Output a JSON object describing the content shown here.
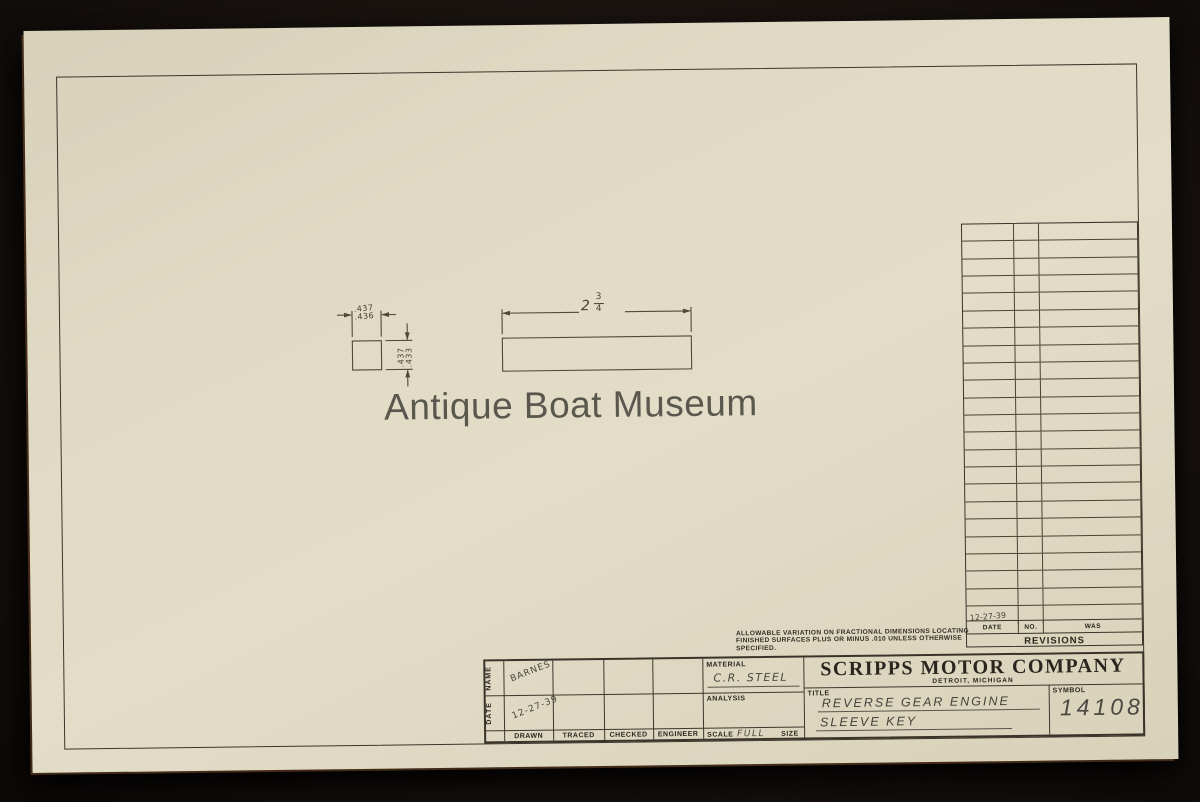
{
  "watermark": "Antique Boat Museum",
  "company": {
    "name": "SCRIPPS MOTOR COMPANY",
    "location": "DETROIT, MICHIGAN"
  },
  "tolerance_note": {
    "line1": "ALLOWABLE VARIATION ON FRACTIONAL DIMENSIONS LOCATING",
    "line2": "FINISHED SURFACES PLUS OR MINUS .010 UNLESS OTHERWISE",
    "line3": "SPECIFIED."
  },
  "dimensions": {
    "width_upper": ".437",
    "width_lower": ".436",
    "height_upper": ".437",
    "height_lower": ".433",
    "length_whole": "2",
    "length_numerator": "3",
    "length_denominator": "4"
  },
  "title_block": {
    "name_label": "NAME",
    "date_label": "DATE",
    "role_labels": [
      "DRAWN",
      "TRACED",
      "CHECKED",
      "ENGINEER"
    ],
    "drawn_name": "BARNES",
    "drawn_date": "12-27-39",
    "material_label": "MATERIAL",
    "material_value": "C.R. STEEL",
    "analysis_label": "ANALYSIS",
    "scale_label": "SCALE",
    "scale_value": "FULL",
    "size_label": "SIZE",
    "title_label": "TITLE",
    "title_line1": "REVERSE GEAR ENGINE",
    "title_line2": "SLEEVE KEY",
    "symbol_label": "SYMBOL",
    "symbol_value": "14108"
  },
  "revisions": {
    "heading": "REVISIONS",
    "columns": [
      "DATE",
      "NO.",
      "WAS"
    ],
    "empty_row_count": 22,
    "entry_date": "12-27-39"
  }
}
